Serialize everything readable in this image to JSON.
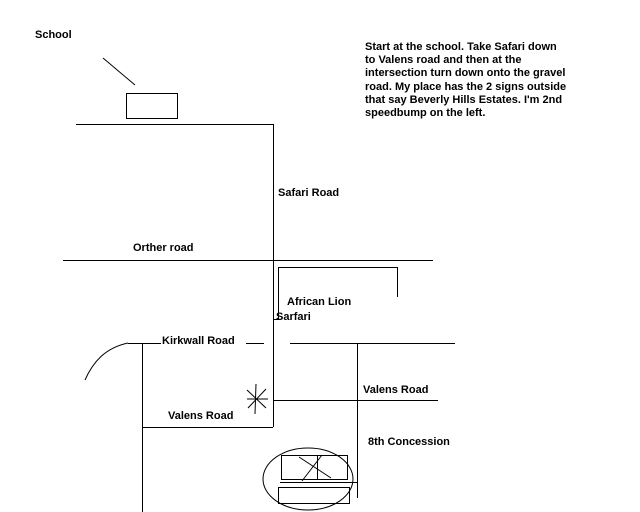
{
  "canvas": {
    "background_color": "#ffffff",
    "ink_color": "#000000"
  },
  "labels": {
    "school": "School",
    "safari_road": "Safari Road",
    "orther_road": "Orther road",
    "african_lion_line1": "African Lion",
    "african_lion_line2": "Sarfari",
    "kirkwall_road": "Kirkwall Road",
    "valens_road_left": "Valens Road",
    "valens_road_right": "Valens Road",
    "eighth_concession": "8th Concession"
  },
  "directions": {
    "lines": [
      "Start at the school. Take Safari down",
      "to Valens road and then at the",
      "intersection turn down onto the gravel",
      "road. My place has the 2 signs outside",
      "that say Beverly Hills Estates. I'm 2nd",
      "speedbump on the left."
    ]
  }
}
